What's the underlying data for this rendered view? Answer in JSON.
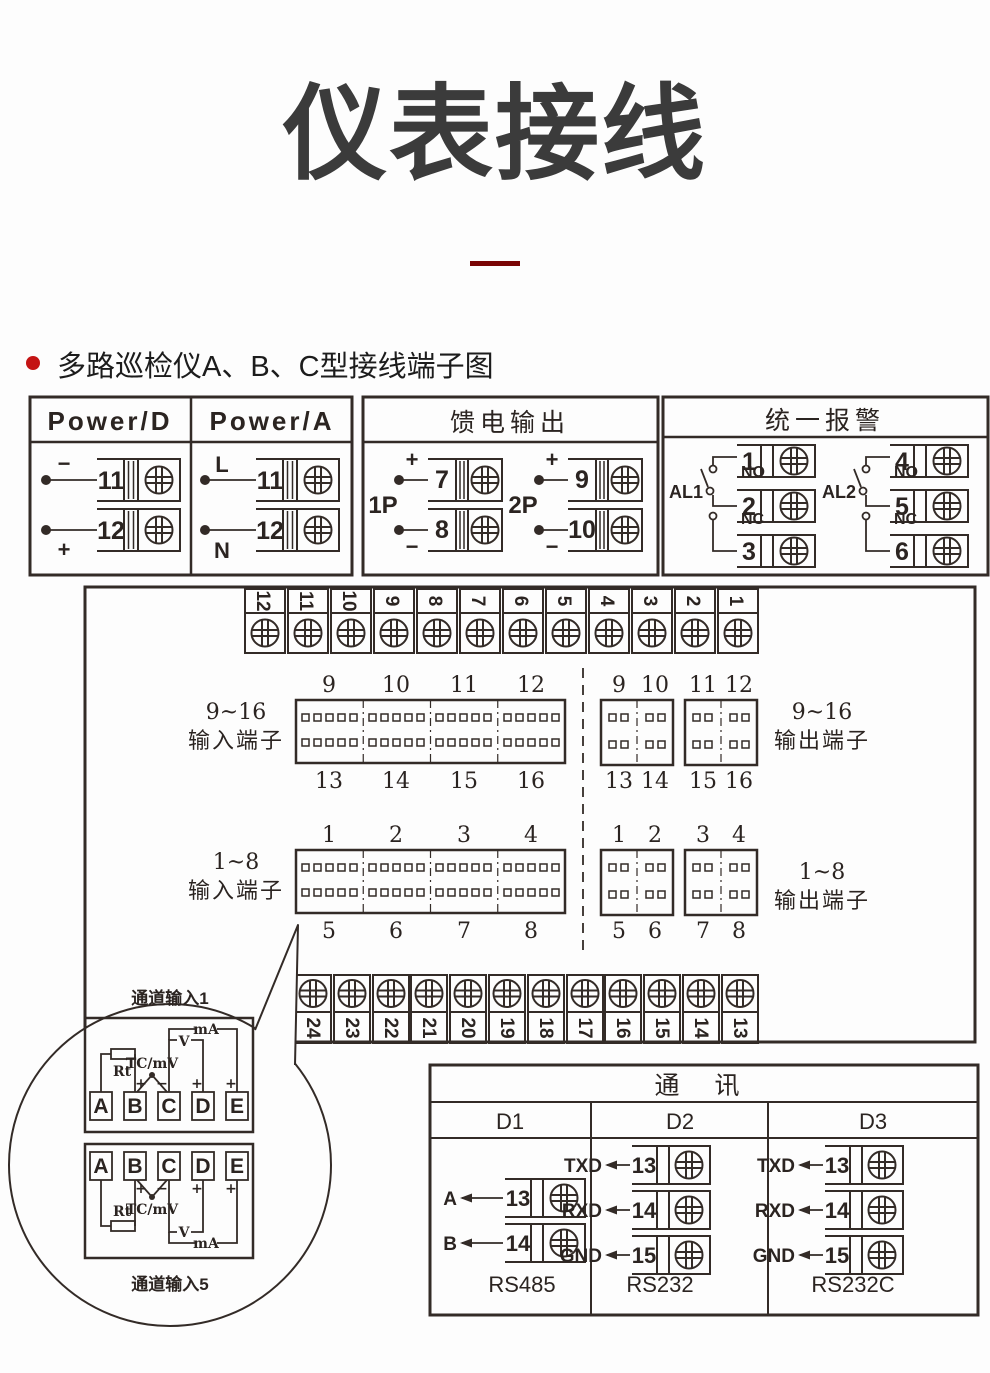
{
  "page": {
    "title": "仪表接线",
    "bullet_text": "多路巡检仪A、B、C型接线端子图",
    "colors": {
      "accent_red": "#c41414",
      "divider_red": "#7a0505",
      "line": "#332b27"
    }
  },
  "power_box": {
    "header_d": "Power/D",
    "header_a": "Power/A",
    "d_top_sign": "−",
    "d_bottom_sign": "+",
    "a_top_sign": "L",
    "a_bottom_sign": "N",
    "d_terminals": [
      "11",
      "12"
    ],
    "a_terminals": [
      "11",
      "12"
    ]
  },
  "feed_box": {
    "title": "馈电输出",
    "plus": "+",
    "minus": "−",
    "groups": [
      {
        "label": "1P",
        "terminals": [
          "7",
          "8"
        ]
      },
      {
        "label": "2P",
        "terminals": [
          "9",
          "10"
        ]
      }
    ]
  },
  "alarm_box": {
    "title": "统一报警",
    "no_label": "NO",
    "nc_label": "NC",
    "groups": [
      {
        "label": "AL1",
        "terminals": [
          "1",
          "2",
          "3"
        ]
      },
      {
        "label": "AL2",
        "terminals": [
          "4",
          "5",
          "6"
        ]
      }
    ]
  },
  "main_board": {
    "top_strip": [
      "12",
      "11",
      "10",
      "9",
      "8",
      "7",
      "6",
      "5",
      "4",
      "3",
      "2",
      "1"
    ],
    "bottom_strip": [
      "24",
      "23",
      "22",
      "21",
      "20",
      "19",
      "18",
      "17",
      "16",
      "15",
      "14",
      "13"
    ],
    "input916": {
      "range": "9~16",
      "label": "输入端子",
      "top": [
        "9",
        "10",
        "11",
        "12"
      ],
      "bottom": [
        "13",
        "14",
        "15",
        "16"
      ]
    },
    "output916": {
      "range": "9~16",
      "label": "输出端子",
      "top": [
        "9",
        "10",
        "11",
        "12"
      ],
      "bottom": [
        "13",
        "14",
        "15",
        "16"
      ]
    },
    "input18": {
      "range": "1~8",
      "label": "输入端子",
      "top": [
        "1",
        "2",
        "3",
        "4"
      ],
      "bottom": [
        "5",
        "6",
        "7",
        "8"
      ]
    },
    "output18": {
      "range": "1~8",
      "label": "输出端子",
      "top": [
        "1",
        "2",
        "3",
        "4"
      ],
      "bottom": [
        "5",
        "6",
        "7",
        "8"
      ]
    }
  },
  "balloon": {
    "top_label": "通道输入1",
    "bottom_label": "通道输入5",
    "terminals": [
      "A",
      "B",
      "C",
      "D",
      "E"
    ],
    "rt": "Rt",
    "tc_mv": "TC/mV",
    "v": "V",
    "ma": "mA",
    "plus": "+",
    "minus": "−"
  },
  "comm_box": {
    "title": "通  讯",
    "columns": [
      {
        "name": "D1",
        "standard": "RS485",
        "rows": [
          {
            "signal": "A",
            "terminal": "13"
          },
          {
            "signal": "B",
            "terminal": "14"
          }
        ]
      },
      {
        "name": "D2",
        "standard": "RS232",
        "rows": [
          {
            "signal": "TXD",
            "terminal": "13"
          },
          {
            "signal": "RXD",
            "terminal": "14"
          },
          {
            "signal": "GND",
            "terminal": "15"
          }
        ]
      },
      {
        "name": "D3",
        "standard": "RS232C",
        "rows": [
          {
            "signal": "TXD",
            "terminal": "13"
          },
          {
            "signal": "RXD",
            "terminal": "14"
          },
          {
            "signal": "GND",
            "terminal": "15"
          }
        ]
      }
    ]
  }
}
